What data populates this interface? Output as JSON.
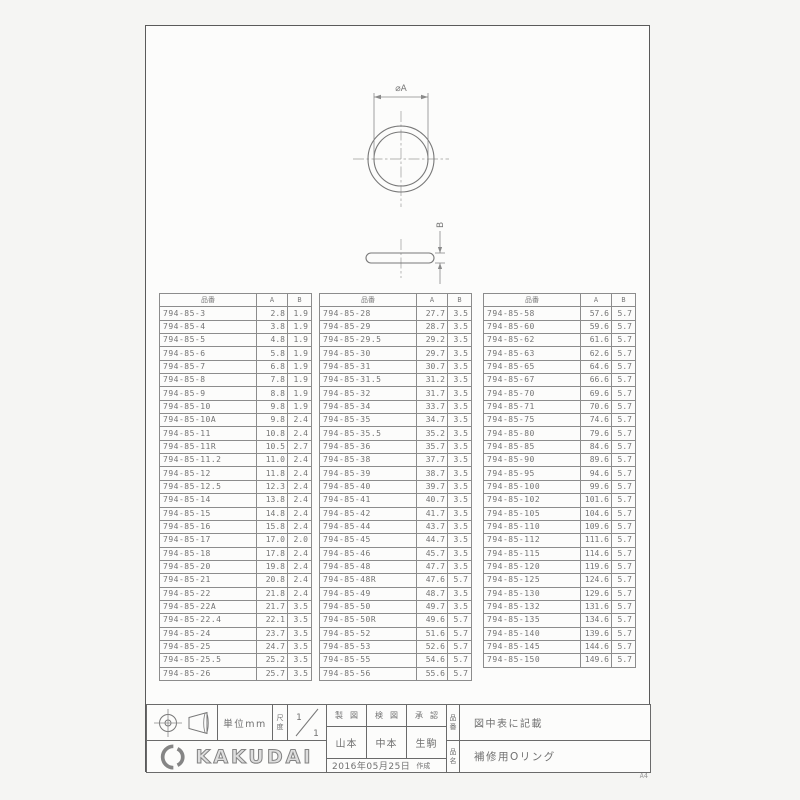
{
  "sheet": {
    "paper_size_label": "A4"
  },
  "drawing": {
    "top_view_dim_label": "⌀A",
    "side_view_dim_label": "B"
  },
  "table_header": {
    "part": "品番",
    "a": "A",
    "b": "B"
  },
  "tables": [
    {
      "rows": [
        [
          "794-85-3",
          "2.8",
          "1.9"
        ],
        [
          "794-85-4",
          "3.8",
          "1.9"
        ],
        [
          "794-85-5",
          "4.8",
          "1.9"
        ],
        [
          "794-85-6",
          "5.8",
          "1.9"
        ],
        [
          "794-85-7",
          "6.8",
          "1.9"
        ],
        [
          "794-85-8",
          "7.8",
          "1.9"
        ],
        [
          "794-85-9",
          "8.8",
          "1.9"
        ],
        [
          "794-85-10",
          "9.8",
          "1.9"
        ],
        [
          "794-85-10A",
          "9.8",
          "2.4"
        ],
        [
          "794-85-11",
          "10.8",
          "2.4"
        ],
        [
          "794-85-11R",
          "10.5",
          "2.7"
        ],
        [
          "794-85-11.2",
          "11.0",
          "2.4"
        ],
        [
          "794-85-12",
          "11.8",
          "2.4"
        ],
        [
          "794-85-12.5",
          "12.3",
          "2.4"
        ],
        [
          "794-85-14",
          "13.8",
          "2.4"
        ],
        [
          "794-85-15",
          "14.8",
          "2.4"
        ],
        [
          "794-85-16",
          "15.8",
          "2.4"
        ],
        [
          "794-85-17",
          "17.0",
          "2.0"
        ],
        [
          "794-85-18",
          "17.8",
          "2.4"
        ],
        [
          "794-85-20",
          "19.8",
          "2.4"
        ],
        [
          "794-85-21",
          "20.8",
          "2.4"
        ],
        [
          "794-85-22",
          "21.8",
          "2.4"
        ],
        [
          "794-85-22A",
          "21.7",
          "3.5"
        ],
        [
          "794-85-22.4",
          "22.1",
          "3.5"
        ],
        [
          "794-85-24",
          "23.7",
          "3.5"
        ],
        [
          "794-85-25",
          "24.7",
          "3.5"
        ],
        [
          "794-85-25.5",
          "25.2",
          "3.5"
        ],
        [
          "794-85-26",
          "25.7",
          "3.5"
        ]
      ]
    },
    {
      "rows": [
        [
          "794-85-28",
          "27.7",
          "3.5"
        ],
        [
          "794-85-29",
          "28.7",
          "3.5"
        ],
        [
          "794-85-29.5",
          "29.2",
          "3.5"
        ],
        [
          "794-85-30",
          "29.7",
          "3.5"
        ],
        [
          "794-85-31",
          "30.7",
          "3.5"
        ],
        [
          "794-85-31.5",
          "31.2",
          "3.5"
        ],
        [
          "794-85-32",
          "31.7",
          "3.5"
        ],
        [
          "794-85-34",
          "33.7",
          "3.5"
        ],
        [
          "794-85-35",
          "34.7",
          "3.5"
        ],
        [
          "794-85-35.5",
          "35.2",
          "3.5"
        ],
        [
          "794-85-36",
          "35.7",
          "3.5"
        ],
        [
          "794-85-38",
          "37.7",
          "3.5"
        ],
        [
          "794-85-39",
          "38.7",
          "3.5"
        ],
        [
          "794-85-40",
          "39.7",
          "3.5"
        ],
        [
          "794-85-41",
          "40.7",
          "3.5"
        ],
        [
          "794-85-42",
          "41.7",
          "3.5"
        ],
        [
          "794-85-44",
          "43.7",
          "3.5"
        ],
        [
          "794-85-45",
          "44.7",
          "3.5"
        ],
        [
          "794-85-46",
          "45.7",
          "3.5"
        ],
        [
          "794-85-48",
          "47.7",
          "3.5"
        ],
        [
          "794-85-48R",
          "47.6",
          "5.7"
        ],
        [
          "794-85-49",
          "48.7",
          "3.5"
        ],
        [
          "794-85-50",
          "49.7",
          "3.5"
        ],
        [
          "794-85-50R",
          "49.6",
          "5.7"
        ],
        [
          "794-85-52",
          "51.6",
          "5.7"
        ],
        [
          "794-85-53",
          "52.6",
          "5.7"
        ],
        [
          "794-85-55",
          "54.6",
          "5.7"
        ],
        [
          "794-85-56",
          "55.6",
          "5.7"
        ]
      ]
    },
    {
      "rows": [
        [
          "794-85-58",
          "57.6",
          "5.7"
        ],
        [
          "794-85-60",
          "59.6",
          "5.7"
        ],
        [
          "794-85-62",
          "61.6",
          "5.7"
        ],
        [
          "794-85-63",
          "62.6",
          "5.7"
        ],
        [
          "794-85-65",
          "64.6",
          "5.7"
        ],
        [
          "794-85-67",
          "66.6",
          "5.7"
        ],
        [
          "794-85-70",
          "69.6",
          "5.7"
        ],
        [
          "794-85-71",
          "70.6",
          "5.7"
        ],
        [
          "794-85-75",
          "74.6",
          "5.7"
        ],
        [
          "794-85-80",
          "79.6",
          "5.7"
        ],
        [
          "794-85-85",
          "84.6",
          "5.7"
        ],
        [
          "794-85-90",
          "89.6",
          "5.7"
        ],
        [
          "794-85-95",
          "94.6",
          "5.7"
        ],
        [
          "794-85-100",
          "99.6",
          "5.7"
        ],
        [
          "794-85-102",
          "101.6",
          "5.7"
        ],
        [
          "794-85-105",
          "104.6",
          "5.7"
        ],
        [
          "794-85-110",
          "109.6",
          "5.7"
        ],
        [
          "794-85-112",
          "111.6",
          "5.7"
        ],
        [
          "794-85-115",
          "114.6",
          "5.7"
        ],
        [
          "794-85-120",
          "119.6",
          "5.7"
        ],
        [
          "794-85-125",
          "124.6",
          "5.7"
        ],
        [
          "794-85-130",
          "129.6",
          "5.7"
        ],
        [
          "794-85-132",
          "131.6",
          "5.7"
        ],
        [
          "794-85-135",
          "134.6",
          "5.7"
        ],
        [
          "794-85-140",
          "139.6",
          "5.7"
        ],
        [
          "794-85-145",
          "144.6",
          "5.7"
        ],
        [
          "794-85-150",
          "149.6",
          "5.7"
        ]
      ]
    }
  ],
  "title_block": {
    "unit_label": "単位mm",
    "scale_label": "尺度",
    "scale_numerator": "1",
    "scale_denominator": "1",
    "brand": "KAKUDAI",
    "drafted_label": "製図",
    "checked_label": "検図",
    "approved_label": "承認",
    "drafted_by": "山本",
    "checked_by": "中本",
    "approved_by": "生駒",
    "date_text": "2016年05月25日",
    "created_label": "作成",
    "part_no_label": "品番",
    "part_no_value": "図中表に記載",
    "part_name_label": "品名",
    "part_name_value": "補修用Oリング"
  }
}
